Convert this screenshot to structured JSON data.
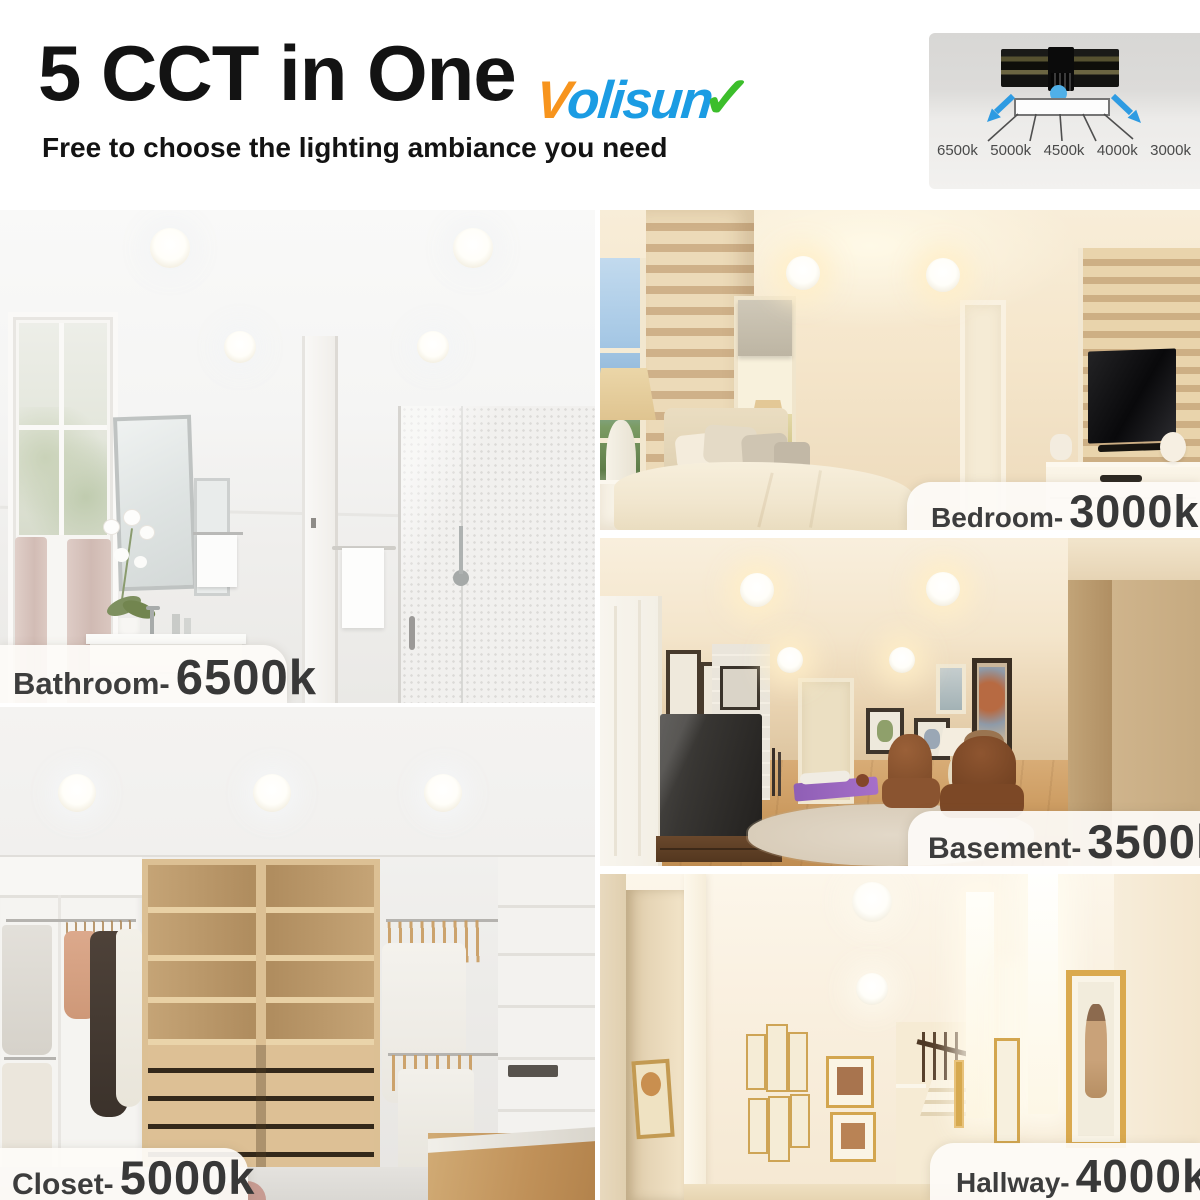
{
  "header": {
    "title": "5 CCT in One",
    "subtitle": "Free to choose the lighting ambiance you need",
    "brand": {
      "v": "V",
      "rest": "olisun",
      "check_icon": "✓",
      "v_color": "#F7941D",
      "text_color": "#1B9CE3",
      "check_color": "#3CBE2B"
    }
  },
  "cct_diagram": {
    "labels": [
      "6500k",
      "5000k",
      "4500k",
      "4000k",
      "3000k"
    ],
    "arrow_color": "#2E9BE2",
    "dot_color": "#4FB0E8"
  },
  "rooms": [
    {
      "name": "Bathroom-",
      "temp": "6500k"
    },
    {
      "name": "Bedroom-",
      "temp": "3000k"
    },
    {
      "name": "Basement-",
      "temp": "3500k"
    },
    {
      "name": "Closet-",
      "temp": "5000k"
    },
    {
      "name": "Hallway-",
      "temp": "4000k"
    }
  ]
}
